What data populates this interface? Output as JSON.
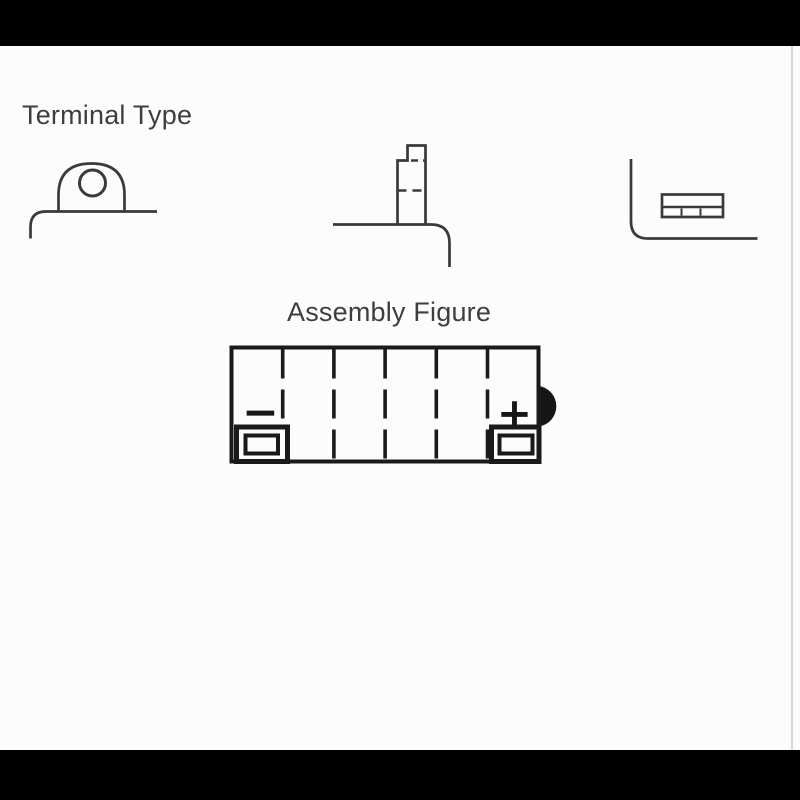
{
  "page": {
    "background": "#fcfcfc",
    "letterbox_color": "#000000",
    "edge_line_color": "#d6d6d6"
  },
  "headings": {
    "terminal_type": "Terminal Type",
    "assembly_figure": "Assembly Figure",
    "text_color": "#3e3e3e"
  },
  "terminal_icons": [
    {
      "name": "tab-with-bolt-hole-terminal"
    },
    {
      "name": "threaded-post-terminal"
    },
    {
      "name": "flat-blade-terminal"
    }
  ],
  "assembly": {
    "cell_count": 6,
    "negative_symbol": "−",
    "positive_symbol": "+",
    "stroke_color": "#1a1a1a"
  },
  "diagram_stroke_color": "#3a3a3a"
}
